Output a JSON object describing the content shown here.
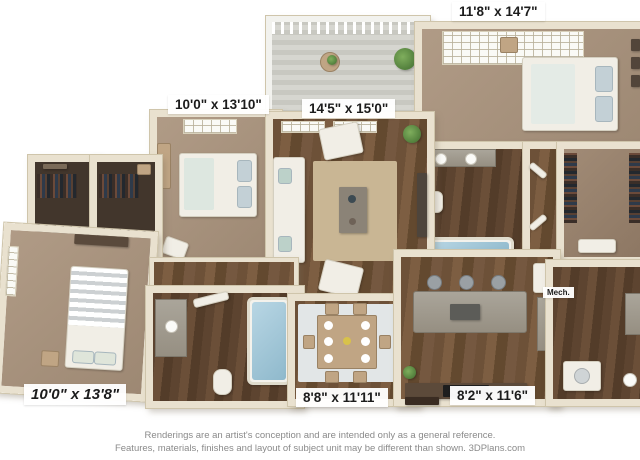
{
  "labels": {
    "master_bedroom": "11'8\" x 14'7\"",
    "bedroom_2": "10'0\" x 13'10\"",
    "living_room": "14'5\" x 15'0\"",
    "bedroom_3": "10'0\" x 13'8\"",
    "dining_room": "8'8\" x 11'11\"",
    "kitchen": "8'2\" x 11'6\"",
    "mech_closet": "Mech."
  },
  "footer": {
    "line1": "Renderings are an artist's conception and are intended only as a general reference.",
    "line2": "Features, materials, finishes and layout of subject unit may be different than shown. 3DPlans.com"
  },
  "colors": {
    "wall": "#e9e1cf",
    "wall_edge": "#cfc5ab",
    "carpet": "#a5907b",
    "wood_floor": "#6f5339",
    "granite": "#9f9a8f",
    "tub_water": "#a9cede",
    "balcony_deck": "#d3d3cd",
    "label_text": "#1c1c1c",
    "footer_text": "#8a8a8a"
  }
}
